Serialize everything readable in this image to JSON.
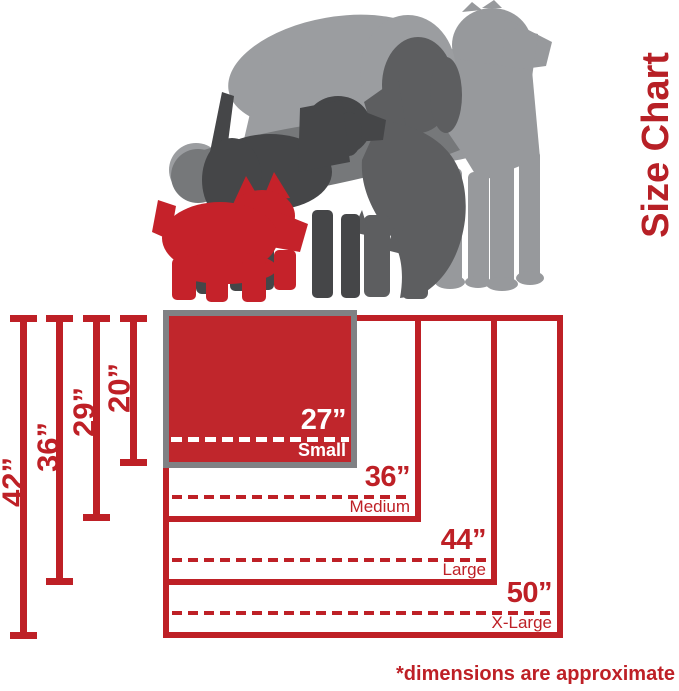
{
  "title": "Size Chart",
  "footnote": "*dimensions are approximate",
  "colors": {
    "red": "#be2026",
    "title_red": "#b72026",
    "box_fill_red": "#c0262c",
    "dog_red": "#c5222a",
    "border_gray": "#808184",
    "dog_light": "#97999c",
    "dog_light2": "#9b9da0",
    "dog_mid": "#76787a",
    "dog_shaggy": "#5d5e60",
    "dog_dark": "#454648",
    "label_white": "#ffffff"
  },
  "sizes": [
    {
      "name": "Small",
      "width_label": "27”",
      "height_label": "20”"
    },
    {
      "name": "Medium",
      "width_label": "36”",
      "height_label": "29”"
    },
    {
      "name": "Large",
      "width_label": "44”",
      "height_label": "36”"
    },
    {
      "name": "X-Large",
      "width_label": "50”",
      "height_label": "42”"
    }
  ],
  "chart_data": {
    "type": "table",
    "title": "Size Chart",
    "columns": [
      "size",
      "width_inches",
      "height_inches"
    ],
    "rows": [
      [
        "Small",
        27,
        20
      ],
      [
        "Medium",
        36,
        29
      ],
      [
        "Large",
        44,
        36
      ],
      [
        "X-Large",
        50,
        42
      ]
    ],
    "note": "*dimensions are approximate"
  },
  "dogs": [
    {
      "name": "large-standing-dog",
      "color": "#97999c"
    },
    {
      "name": "bowing-dog",
      "color": "#9b9da0"
    },
    {
      "name": "lying-mid-gray-dog",
      "color": "#76787a"
    },
    {
      "name": "shaggy-dark-gray-dog",
      "color": "#5d5e60"
    },
    {
      "name": "charcoal-dog",
      "color": "#454648"
    },
    {
      "name": "red-terrier",
      "color": "#c5222a"
    }
  ]
}
